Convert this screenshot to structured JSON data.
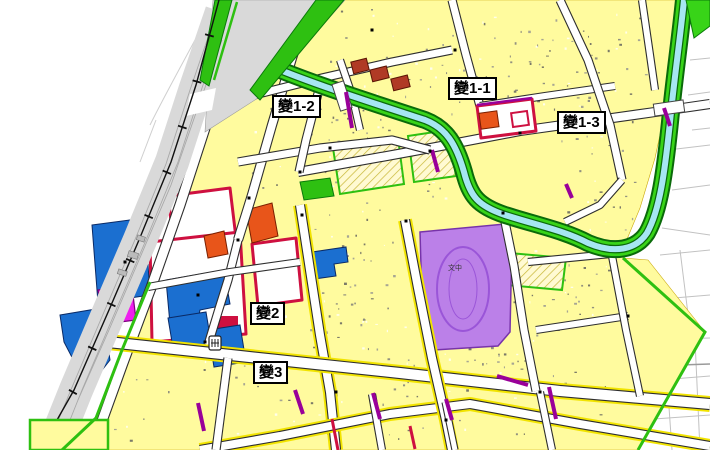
{
  "map": {
    "kind": "urban-planning zoning map",
    "change_area_labels": [
      {
        "id": "bian-1-2",
        "text": "變1-2"
      },
      {
        "id": "bian-1-1",
        "text": "變1-1"
      },
      {
        "id": "bian-1-3",
        "text": "變1-3"
      },
      {
        "id": "bian-2",
        "text": "變2"
      },
      {
        "id": "bian-3",
        "text": "變3"
      }
    ],
    "school_site_label": "文中",
    "colors": {
      "residential_yellow": "#FFFB9E",
      "road_halo_yellow": "#F2E400",
      "commercial_blue": "#1B6FD0",
      "market_magenta": "#EE1FEE",
      "school_purple": "#BB80E8",
      "change_zone_red": "#CE1040",
      "orange_zone": "#E8551A",
      "park_green": "#2EC011",
      "river_bank_green": "#38D418",
      "river_water_cyan": "#A6E6F2",
      "railway_gray": "#D9D9D9",
      "purple_road_marking": "#990099"
    }
  }
}
